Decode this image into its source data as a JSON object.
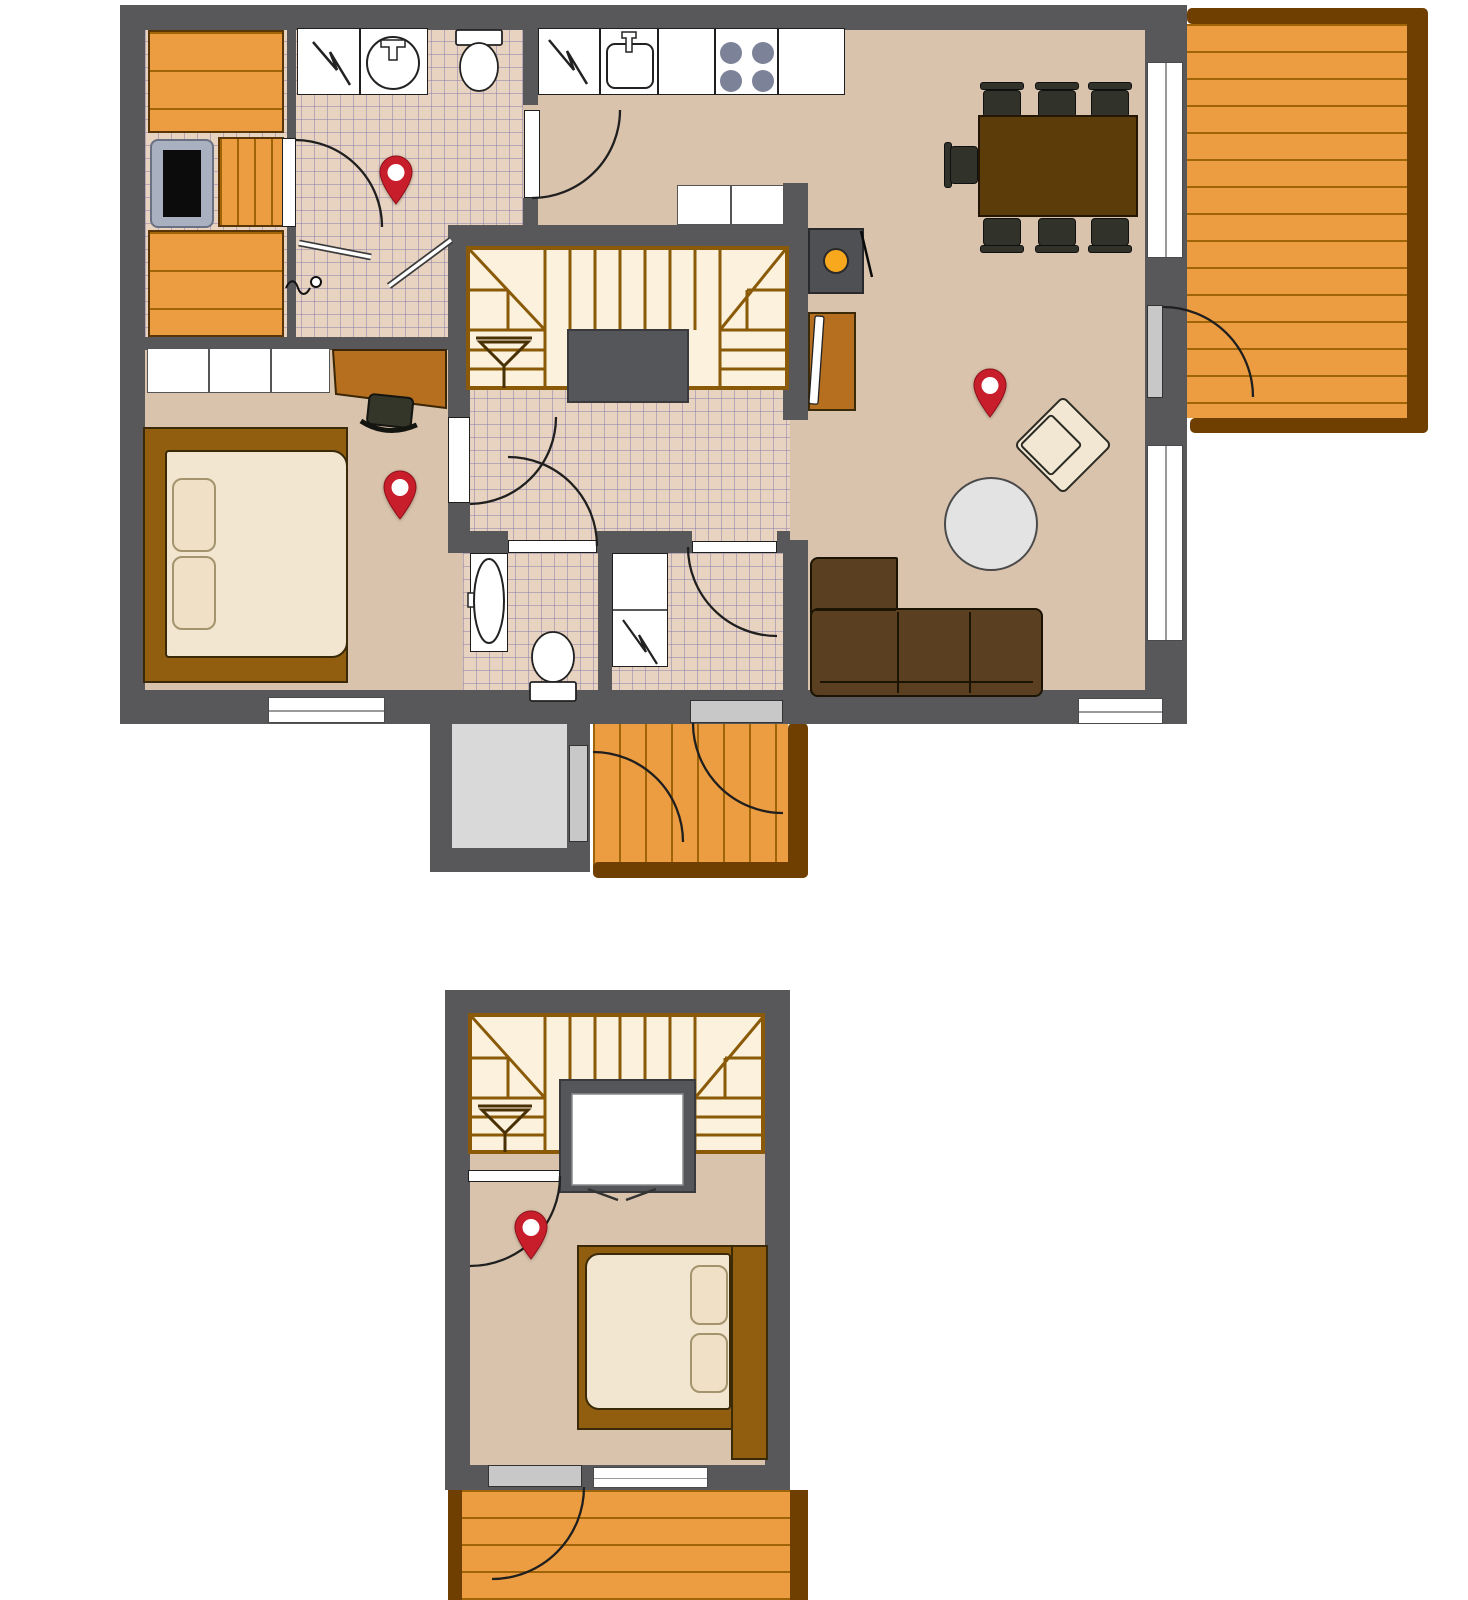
{
  "title": "Two-storey cottage floor plan with four location pins",
  "palette": {
    "wall": "#58585a",
    "floor": "#d9c3ac",
    "tile": "#e8d3c0",
    "tile_line": "rgba(135,125,170,.5)",
    "wood": "#ec9c41",
    "wood_line": "#a06408",
    "wood_dark": "#6e3f00",
    "stair_bg": "#fbf1dc",
    "stair_line": "#8a5a08",
    "sofa": "#5a4020",
    "furn_line": "#1c1403",
    "table": "#5c3c08",
    "chair": "#31322a",
    "mattress": "#f3e6d0",
    "pillow": "#efe0c6",
    "headboard": "#915e10",
    "desk": "#b56f1f",
    "armchair": "#f2e7d2",
    "coffee": "#e3e3e3",
    "storage": "#d9d9d9",
    "graydoor": "#c8c8c8",
    "burner": "#7c8297",
    "fire": "#f8a81c",
    "pin": "#c81e2c"
  },
  "floors": [
    {
      "id": "main",
      "label": "Main floor",
      "rooms": [
        "sauna",
        "washroom",
        "kitchen",
        "dining-area",
        "living-room",
        "bedroom",
        "hallway",
        "wc",
        "utility-room",
        "storage",
        "entry-porch",
        "deck"
      ],
      "furniture": [
        "sauna-benches",
        "sauna-stove",
        "shower",
        "washbasin",
        "toilet",
        "shower-partitions",
        "floor-drain",
        "dishwasher",
        "kitchen-sink",
        "stove-4-burners",
        "base-cabinets-2",
        "dining-table",
        "dining-chairs-7",
        "fireplace",
        "tv-sideboard",
        "u-staircase",
        "wardrobe-3-doors",
        "desk",
        "desk-chair",
        "double-bed-2-pillows",
        "corner-sofa",
        "round-coffee-table",
        "armchair",
        "wc-sink",
        "wc-toilet",
        "water-heater"
      ]
    },
    {
      "id": "upper",
      "label": "Upper floor loft",
      "rooms": [
        "stair-landing",
        "bedroom",
        "balcony"
      ],
      "furniture": [
        "u-staircase",
        "stairwell-void",
        "double-bed-2-pillows"
      ]
    }
  ],
  "pins": {
    "name": "location-pin",
    "count": 4,
    "positions": [
      {
        "floor": "main",
        "room": "washroom",
        "cx": 396,
        "cy": 172
      },
      {
        "floor": "main",
        "room": "bedroom",
        "cx": 400,
        "cy": 487
      },
      {
        "floor": "main",
        "room": "living-room",
        "cx": 990,
        "cy": 385
      },
      {
        "floor": "upper",
        "room": "bedroom",
        "cx": 531,
        "cy": 1227
      }
    ]
  }
}
